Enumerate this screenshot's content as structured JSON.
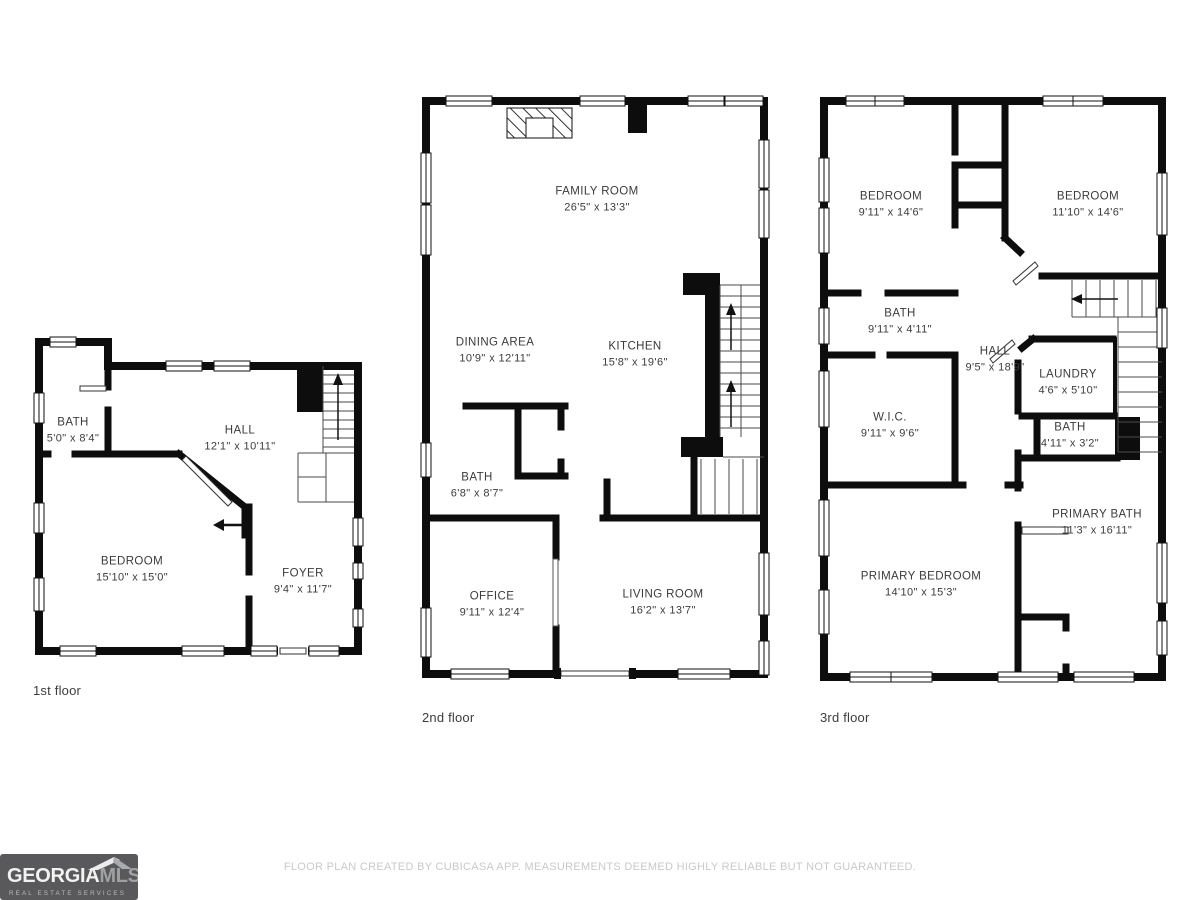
{
  "floors": [
    {
      "label": "1st floor",
      "rooms": [
        {
          "name": "BATH",
          "dims": "5'0\" x 8'4\""
        },
        {
          "name": "HALL",
          "dims": "12'1\" x 10'11\""
        },
        {
          "name": "BEDROOM",
          "dims": "15'10\" x 15'0\""
        },
        {
          "name": "FOYER",
          "dims": "9'4\" x 11'7\""
        }
      ]
    },
    {
      "label": "2nd floor",
      "rooms": [
        {
          "name": "FAMILY ROOM",
          "dims": "26'5\" x 13'3\""
        },
        {
          "name": "DINING AREA",
          "dims": "10'9\" x 12'11\""
        },
        {
          "name": "KITCHEN",
          "dims": "15'8\" x 19'6\""
        },
        {
          "name": "BATH",
          "dims": "6'8\" x 8'7\""
        },
        {
          "name": "OFFICE",
          "dims": "9'11\" x 12'4\""
        },
        {
          "name": "LIVING ROOM",
          "dims": "16'2\" x 13'7\""
        }
      ]
    },
    {
      "label": "3rd floor",
      "rooms": [
        {
          "name": "BEDROOM",
          "dims": "9'11\" x 14'6\""
        },
        {
          "name": "BEDROOM",
          "dims": "11'10\" x 14'6\""
        },
        {
          "name": "BATH",
          "dims": "9'11\" x 4'11\""
        },
        {
          "name": "HALL",
          "dims": "9'5\" x 18'9\""
        },
        {
          "name": "LAUNDRY",
          "dims": "4'6\" x 5'10\""
        },
        {
          "name": "W.I.C.",
          "dims": "9'11\" x 9'6\""
        },
        {
          "name": "BATH",
          "dims": "4'11\" x 3'2\""
        },
        {
          "name": "PRIMARY BATH",
          "dims": "11'3\" x 16'11\""
        },
        {
          "name": "PRIMARY BEDROOM",
          "dims": "14'10\" x 15'3\""
        }
      ]
    }
  ],
  "footer": {
    "disclaimer": "FLOOR PLAN CREATED BY CUBICASA APP. MEASUREMENTS DEEMED HIGHLY RELIABLE BUT NOT GUARANTEED."
  },
  "logo": {
    "brand_primary": "GEORGIA",
    "brand_secondary": "MLS",
    "tagline": "REAL ESTATE SERVICES"
  },
  "colors": {
    "wall": "#0d0d0d",
    "label_text": "#3b3b3b",
    "footer_text": "#c9c9c9",
    "logo_background": "#59595b"
  }
}
